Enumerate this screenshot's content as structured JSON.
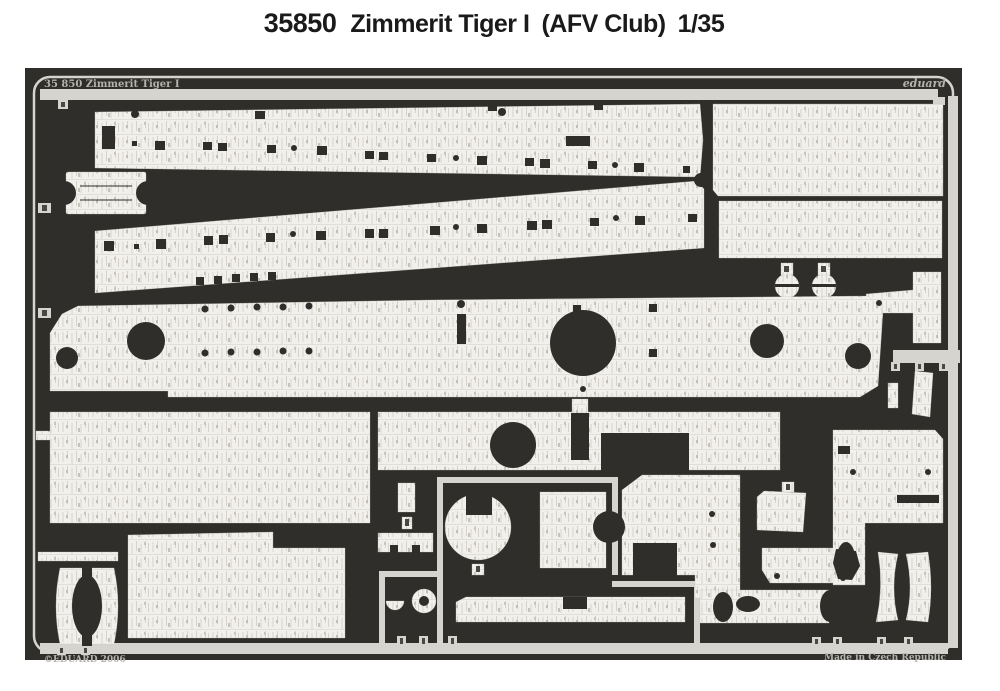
{
  "header": {
    "catalog_number": "35850",
    "product_name": "Zimmerit Tiger I",
    "kit_brand": "(AFV Club)",
    "scale": "1/35"
  },
  "sheet": {
    "corner_label": "35 850 Zimmerit Tiger I",
    "brand": "eduard",
    "copyright": "©EDUARD 2006",
    "made_in": "Made in Czech Republic",
    "colors": {
      "base": "#2f2e2a",
      "metal": "#f1f0ec",
      "frame": "#d5d4ce",
      "line": "#d3d0c8",
      "etch": "#b4b3ad"
    }
  }
}
